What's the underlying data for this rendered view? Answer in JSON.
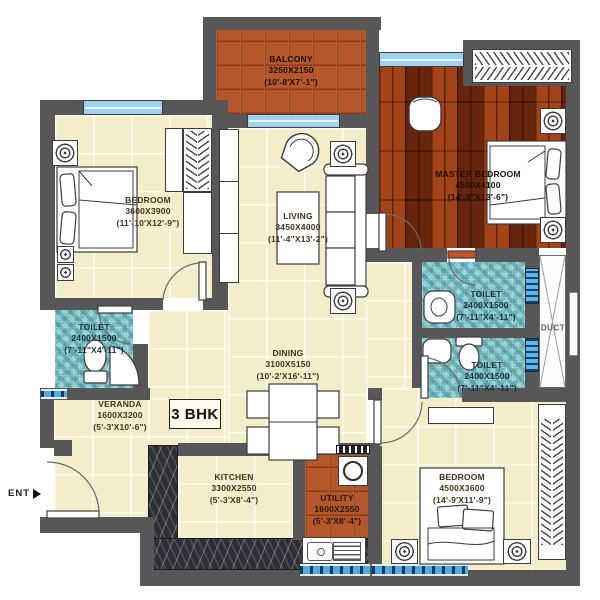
{
  "plan": {
    "type_badge": "3 BHK",
    "entrance_label": "ENT",
    "duct_label": "DUCT",
    "rooms": [
      {
        "name": "BEDROOM",
        "dim": "3600X3900",
        "ft": "(11'-10'X12'-9\")"
      },
      {
        "name": "BALCONY",
        "dim": "3250X2150",
        "ft": "(10'-8'X7'-1\")"
      },
      {
        "name": "MASTER BEDROOM",
        "dim": "4500X4100",
        "ft": "(14'-9\"X13'-6\")"
      },
      {
        "name": "LIVING",
        "dim": "3450X4000",
        "ft": "(11'-4\"X13'-2\")"
      },
      {
        "name": "TOILET",
        "dim": "2400X1500",
        "ft": "(7'-11\"X4'-11\")"
      },
      {
        "name": "TOILET",
        "dim": "2400X1500",
        "ft": "(7'-11\"X4'-11\")"
      },
      {
        "name": "TOILET",
        "dim": "2400X1500",
        "ft": "(7'-11\"X4'-11\")"
      },
      {
        "name": "DINING",
        "dim": "3100X5150",
        "ft": "(10'-2'X16'-11\")"
      },
      {
        "name": "VERANDA",
        "dim": "1600X3200",
        "ft": "(5'-3'X10'-6\")"
      },
      {
        "name": "KITCHEN",
        "dim": "3300X2550",
        "ft": "(5'-3'X8'-4\")"
      },
      {
        "name": "UTILITY",
        "dim": "1600X2550",
        "ft": "(5'-3'X8'-4\")"
      },
      {
        "name": "BEDROOM",
        "dim": "4500X3600",
        "ft": "(14'-9'X11'-9\")"
      }
    ],
    "colors": {
      "wall": "#57575a",
      "floor": "#f3edc9",
      "balcony": "#b4582c",
      "wood": "#8f3510",
      "mosaic": "#8ec9c5",
      "window": "#9ed2f0",
      "marble": "#2e2e35"
    }
  }
}
